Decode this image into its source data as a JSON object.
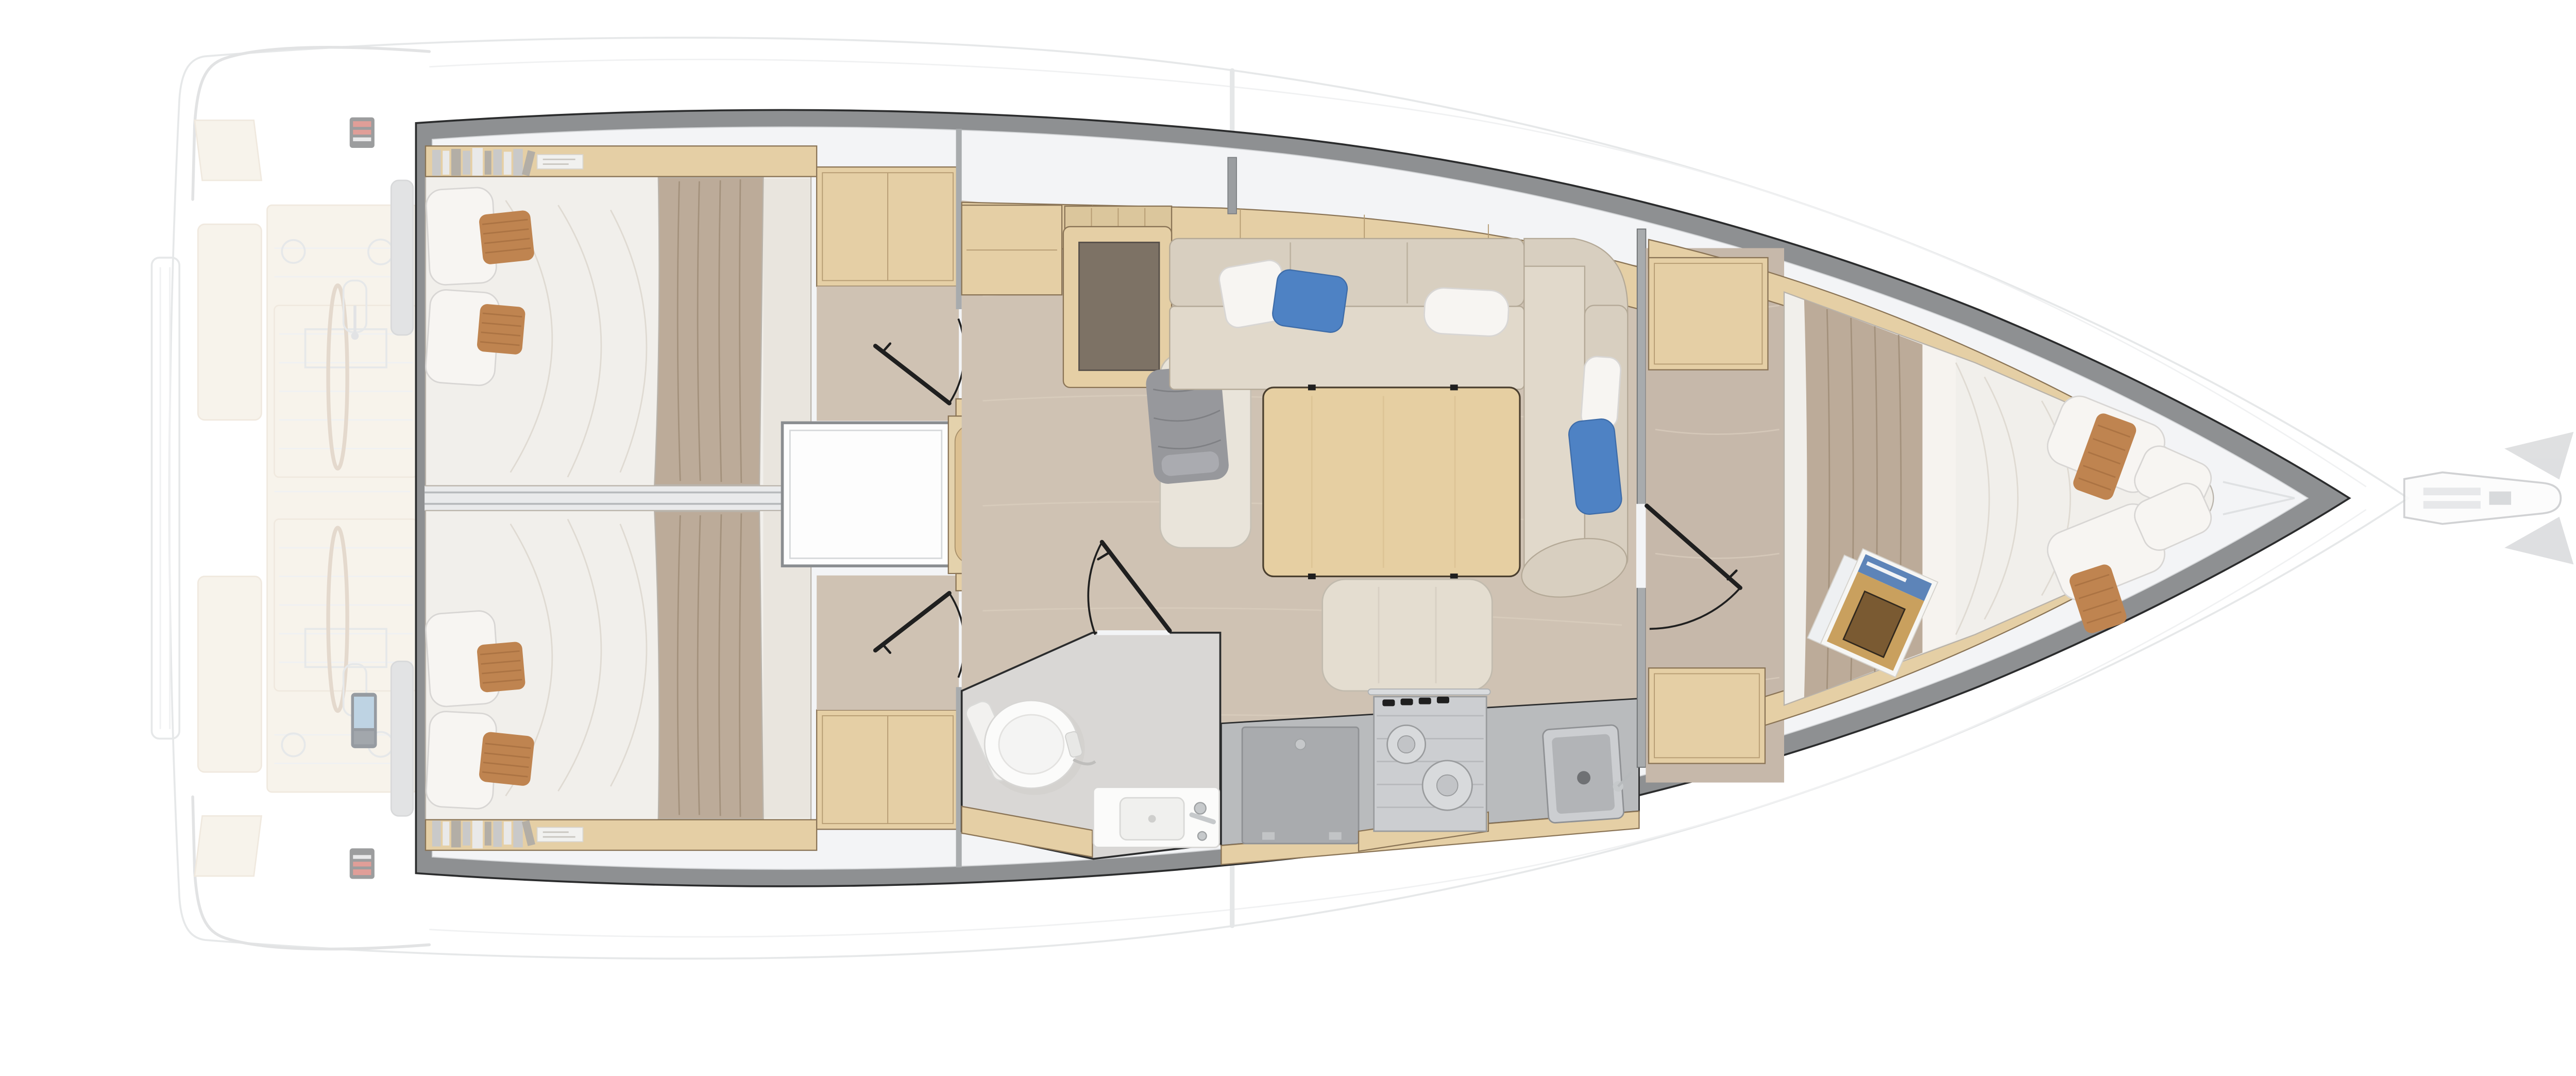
{
  "scene": {
    "kind": "sailing-yacht-interior-floor-plan",
    "view": "top-down",
    "orientation": "bow-right-stern-left"
  },
  "palette": {
    "white": "#ffffff",
    "ghost_fill": "#fdfdfd",
    "ghost_line": "#cfd2d4",
    "ghost_teak": "#f1e8d9",
    "ghost_gray": "#c7c9cb",
    "hull_band": "#8e9092",
    "liner": "#f3f4f6",
    "wood": "#e5cfa5",
    "wood_dark": "#dbc69c",
    "steps": "#dcc091",
    "floor": "#cfc2b3",
    "floor_grain": "#dccfc0",
    "carpet": "#c6b8aa",
    "wall": "#a8abad",
    "door": "#1f1f1f",
    "bed": "#f1efeb",
    "bed_sheet": "#e9e5de",
    "blanket": "#bcab99",
    "pillow": "#f7f5f2",
    "terracotta": "#bf8450",
    "terracotta_line": "#a06a3c",
    "blue": "#4e82c4",
    "sofa": "#d8cfc0",
    "sofa_seat": "#e1d9cb",
    "gray_blanket": "#97989c",
    "table": "#e6cfa2",
    "ottoman": "#e4ddd0",
    "head_floor": "#d9d7d5",
    "fixture": "#fbfbfa",
    "counter": "#b9bbbd",
    "fridge": "#a9abae",
    "stainless": "#ccced1",
    "stainless_dark": "#b2b4b7",
    "metal": "#c6c9cb",
    "post": "#9b9ea1",
    "book1": "#c9c9c9",
    "book2": "#e9e9e9",
    "book3": "#b3aea6",
    "red_instrument": "#c23f33",
    "screen_blue": "#7fa8c9"
  },
  "components": [
    "swim-platform",
    "pushpit-rails",
    "cockpit",
    "helm-wheels",
    "helm-consoles",
    "helm-seats",
    "hull",
    "interior-liner",
    "aft-cabin-port",
    "aft-cabin-starboard",
    "engine-compartment",
    "companionway-steps",
    "salon",
    "chart-table",
    "nav-seat",
    "salon-sofa",
    "salon-table",
    "ottoman",
    "head-compartment",
    "toilet",
    "vanity-sink",
    "galley",
    "fridge",
    "stove",
    "sink",
    "forward-cabin",
    "v-berth-bed",
    "wardrobes",
    "bowsprit",
    "anchor"
  ]
}
